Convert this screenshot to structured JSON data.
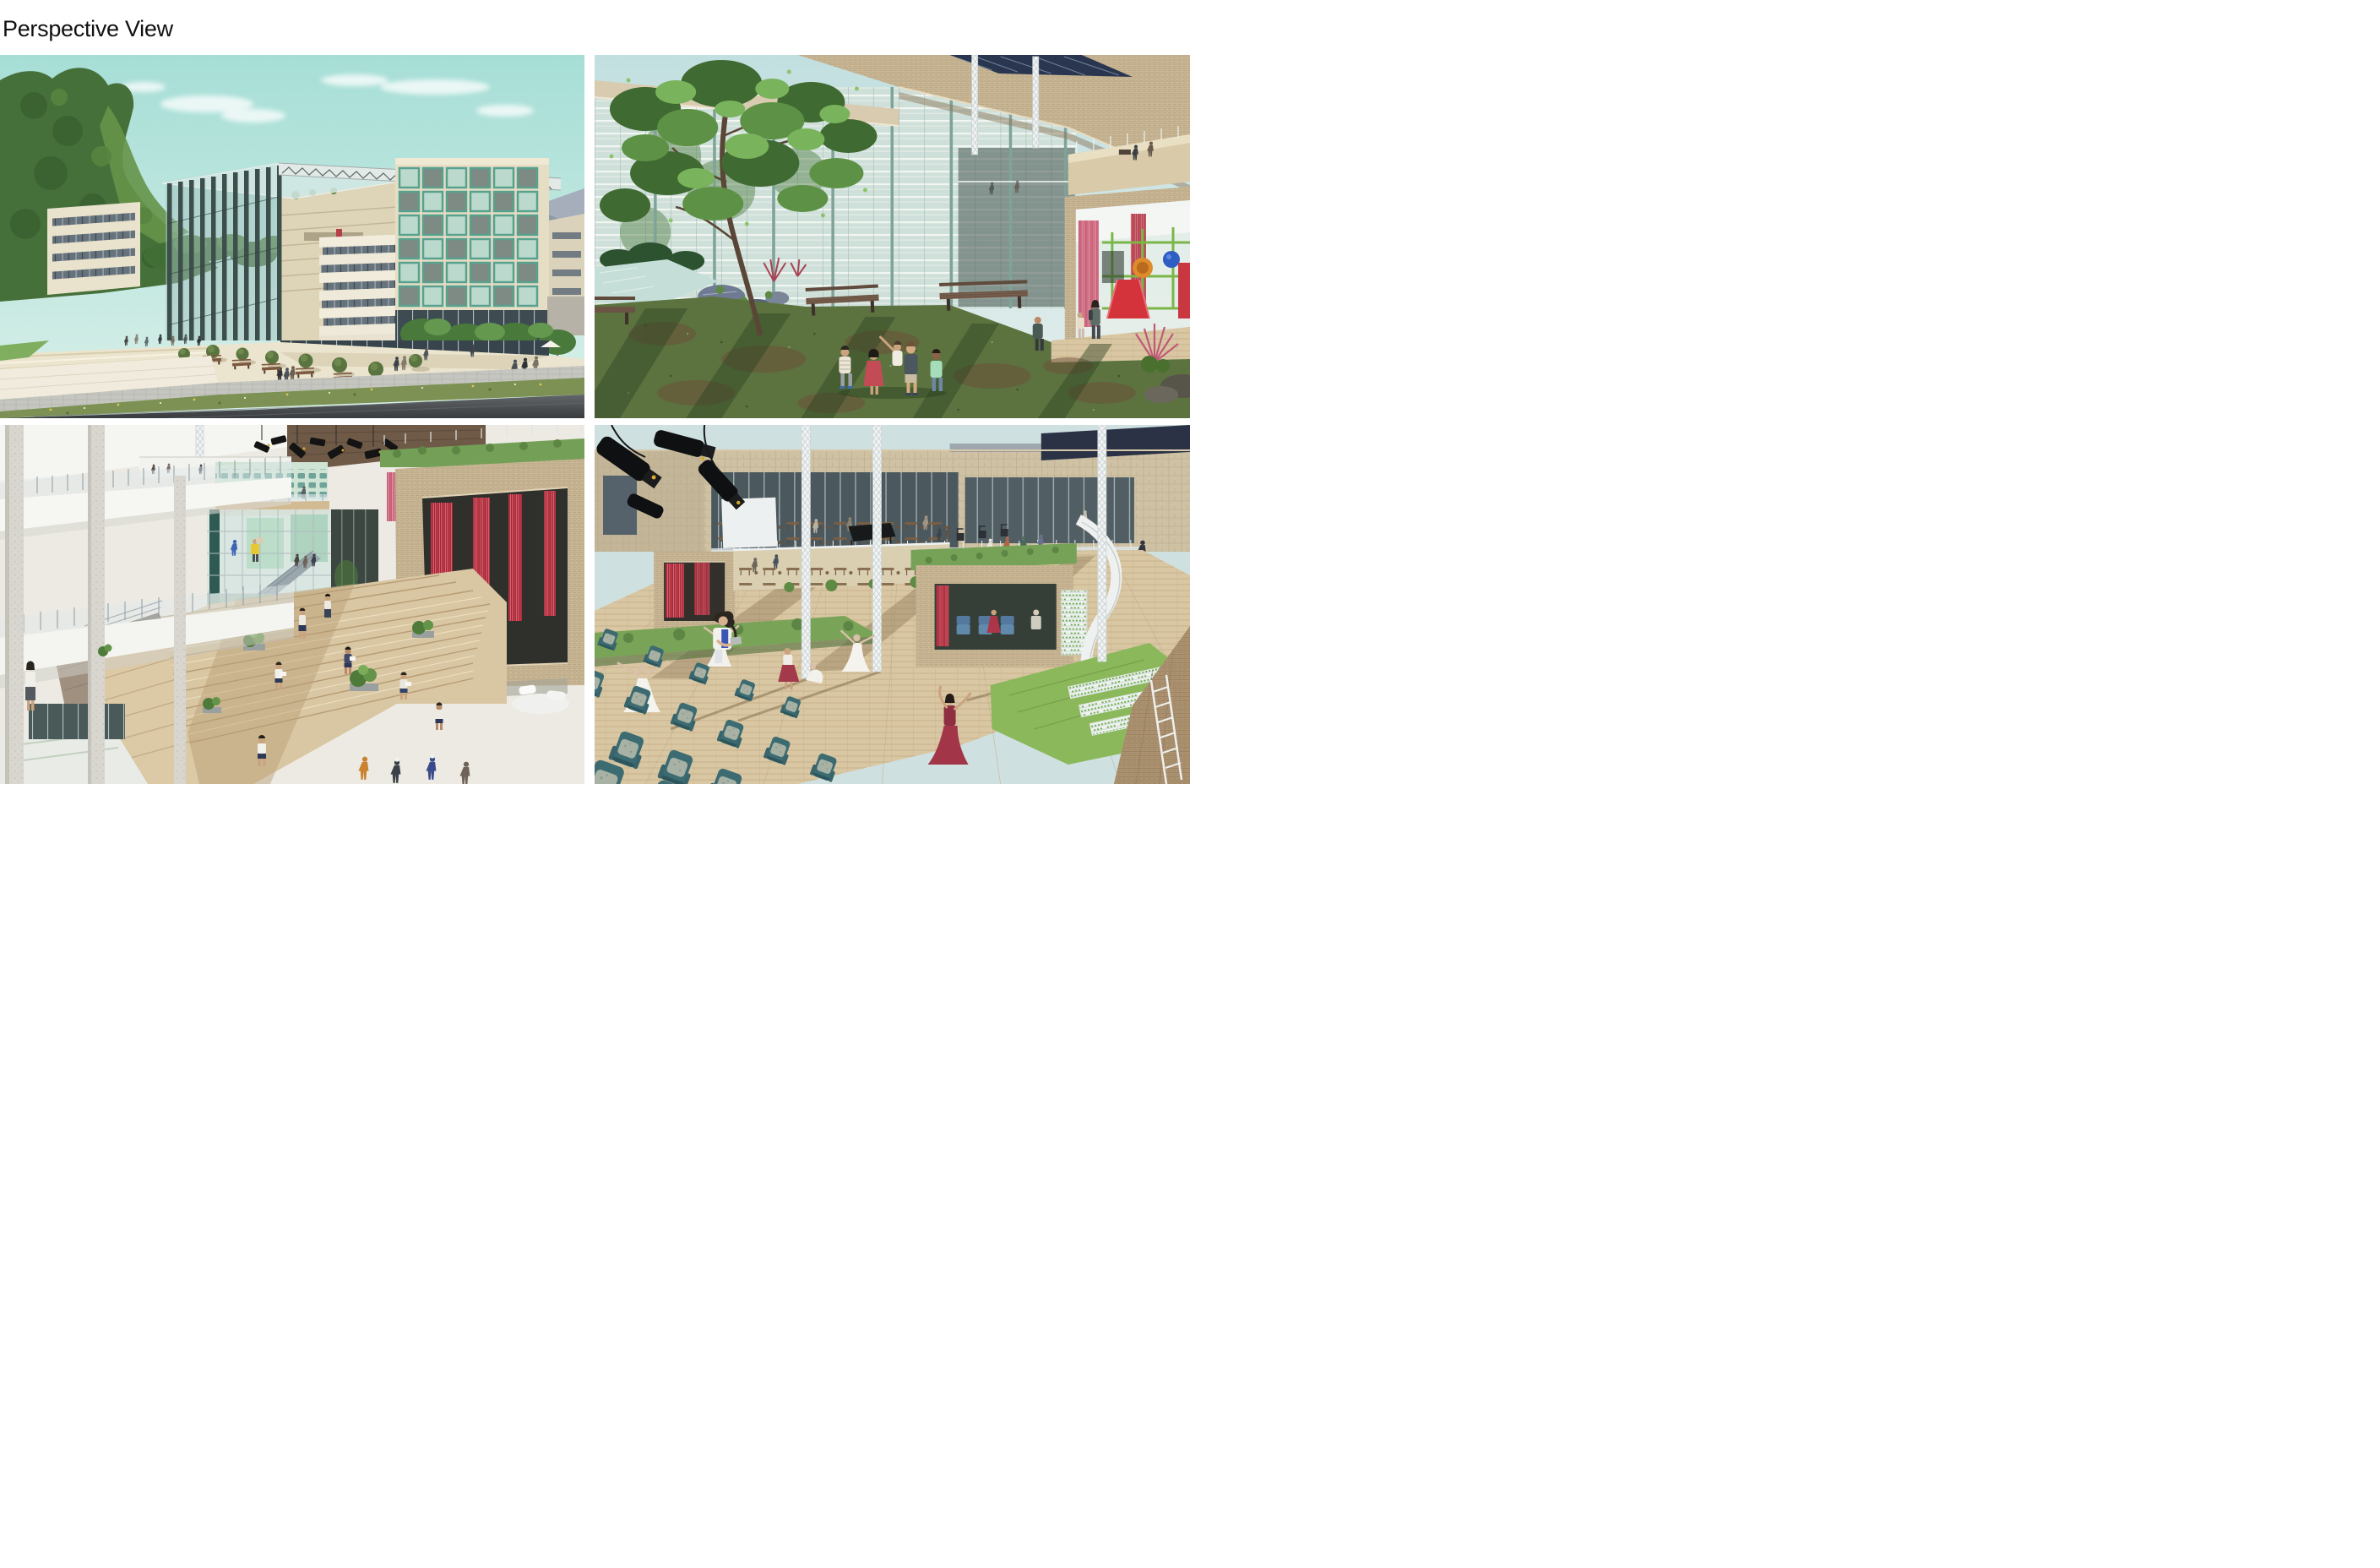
{
  "page": {
    "title": "Perspective View",
    "background_color": "#ffffff",
    "title_color": "#111111"
  },
  "panels": [
    {
      "id": "exterior",
      "position": "top-left",
      "name": "exterior-street-perspective",
      "description": "Street-level exterior perspective: glass atrium volume with dark steel lattice facade and truss roof, stepped beige stone terraces, white ribbon-window building, apartment tower with teal balcony frames, public plaza with wide steps, round shrubs, benches and pedestrians, wildflower verge and asphalt road in the foreground, wooded green hill, distant blue mountain and pale teal sky.",
      "palette": {
        "sky": "#aadfd8",
        "hill": "#46703a",
        "stone": "#ebe4ce",
        "balcony_teal": "#57a28f",
        "road": "#3c3f41"
      }
    },
    {
      "id": "courtyard",
      "position": "top-right",
      "name": "courtyard-garden-perspective",
      "description": "Semi-open courtyard under travertine sky-bridges and a dark blue roof truss: a large tree over a rock garden and pond on the left, five children standing on red-green ground cover crossed by long shadows, timber benches, fritted green glass curtain wall behind, and a glazed children's playroom with pink and red curtains and a colourful play structure with slide, tunnel and ball on the right.",
      "palette": {
        "ground": "#5c7340",
        "glass": "#cfe0da",
        "concrete": "#c9b795",
        "curtain_red": "#c23c4c",
        "play_red": "#d5333b"
      }
    },
    {
      "id": "atrium",
      "position": "bottom-left",
      "name": "interior-atrium-perspective",
      "description": "Interior atrium perspective: white balcony decks with glass railings and speckled concrete columns on the left, a crowded upper bridge, black stage-light rig under a dark timber soffit, upper auditorium seating with dancers, full-height glazing with escalator and workers in hi-vis vests, a floating travertine box with red curtains and roof garden, and terraced timber seating steps where uniformed students sit reading among planters.",
      "palette": {
        "timber_steps": "#d9c6a2",
        "mint": "#cfe4d4",
        "travertine": "#c9b795",
        "curtain_red": "#c23c4c",
        "white_deck": "#f4f4f0"
      }
    },
    {
      "id": "rooftop",
      "position": "bottom-right",
      "name": "rooftop-amphitheatre-perspective",
      "description": "Rooftop amphitheatre perspective: rows of teal auditorium seats with speckled cushions in the foreground, a seated girl with a tablet, timber deck stage with rehearsing dancers in red and white dresses, black stage spotlights and white lattice masts above, travertine box rooms with red curtains, blue seats and hydroponic racks, green roofs and lawn planters, glazed cafeteria terrace with onlookers behind, and a travertine wall with a white ladder on the right.",
      "palette": {
        "seat_teal": "#3c6b72",
        "deck": "#d9c7a3",
        "lawn": "#8cb85c",
        "stone": "#c9b795",
        "dress_red": "#a23648"
      }
    }
  ]
}
